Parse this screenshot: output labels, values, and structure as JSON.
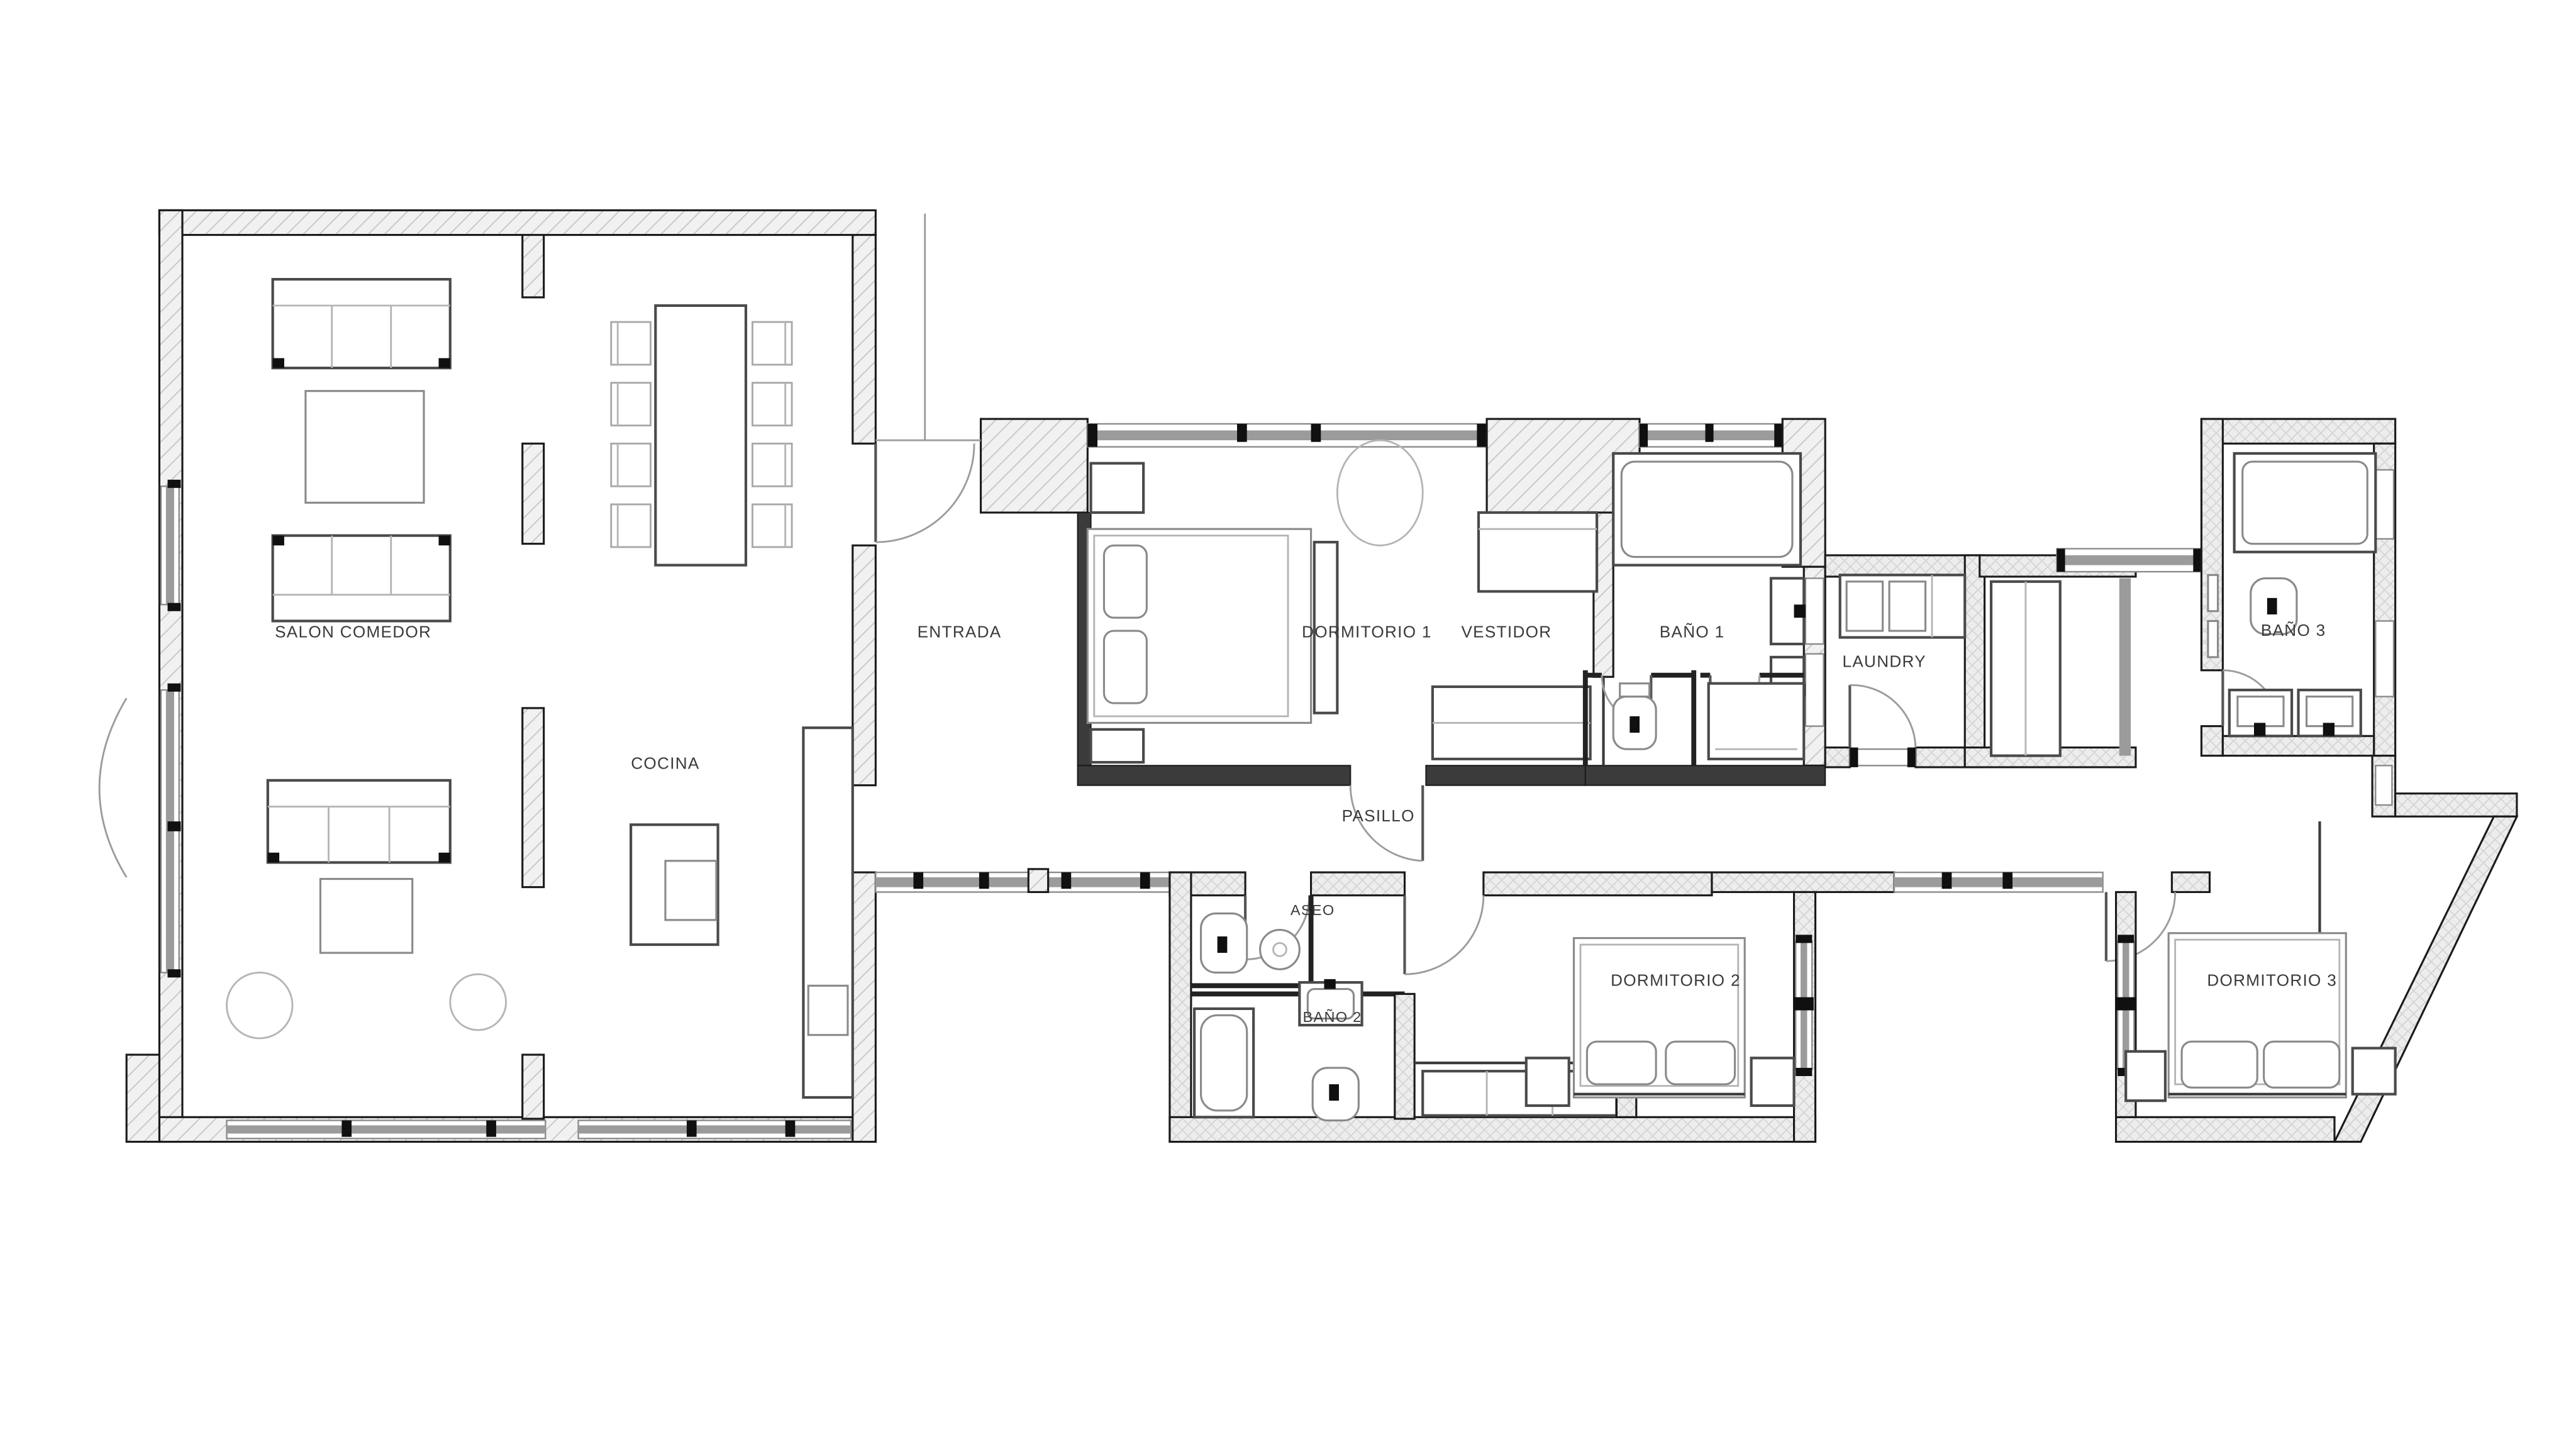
{
  "plan": {
    "type": "floor-plan",
    "rooms": [
      {
        "id": "salon-comedor",
        "label": "SALON COMEDOR"
      },
      {
        "id": "entrada",
        "label": "ENTRADA"
      },
      {
        "id": "dormitorio-1",
        "label": "DORMITORIO 1"
      },
      {
        "id": "vestidor",
        "label": "VESTIDOR"
      },
      {
        "id": "bano-1",
        "label": "BAÑO 1"
      },
      {
        "id": "laundry",
        "label": "LAUNDRY"
      },
      {
        "id": "bano-3",
        "label": "BAÑO 3"
      },
      {
        "id": "cocina",
        "label": "COCINA"
      },
      {
        "id": "pasillo",
        "label": "PASILLO"
      },
      {
        "id": "aseo",
        "label": "ASEO"
      },
      {
        "id": "bano-2",
        "label": "BAÑO 2"
      },
      {
        "id": "dormitorio-2",
        "label": "DORMITORIO 2"
      },
      {
        "id": "dormitorio-3",
        "label": "DORMITORIO 3"
      }
    ],
    "colors": {
      "background": "#ffffff",
      "wall_outline": "#1b1b1b",
      "wall_hatch": "#c6c6c6",
      "wall_fill": "#f1f1f1",
      "window_gray": "#9b9b9b",
      "furniture_dark": "#4a4a4a",
      "furniture_light": "#8a8a8a",
      "door_arc": "#9c9c9c",
      "label_text": "#3a3a3a"
    }
  }
}
